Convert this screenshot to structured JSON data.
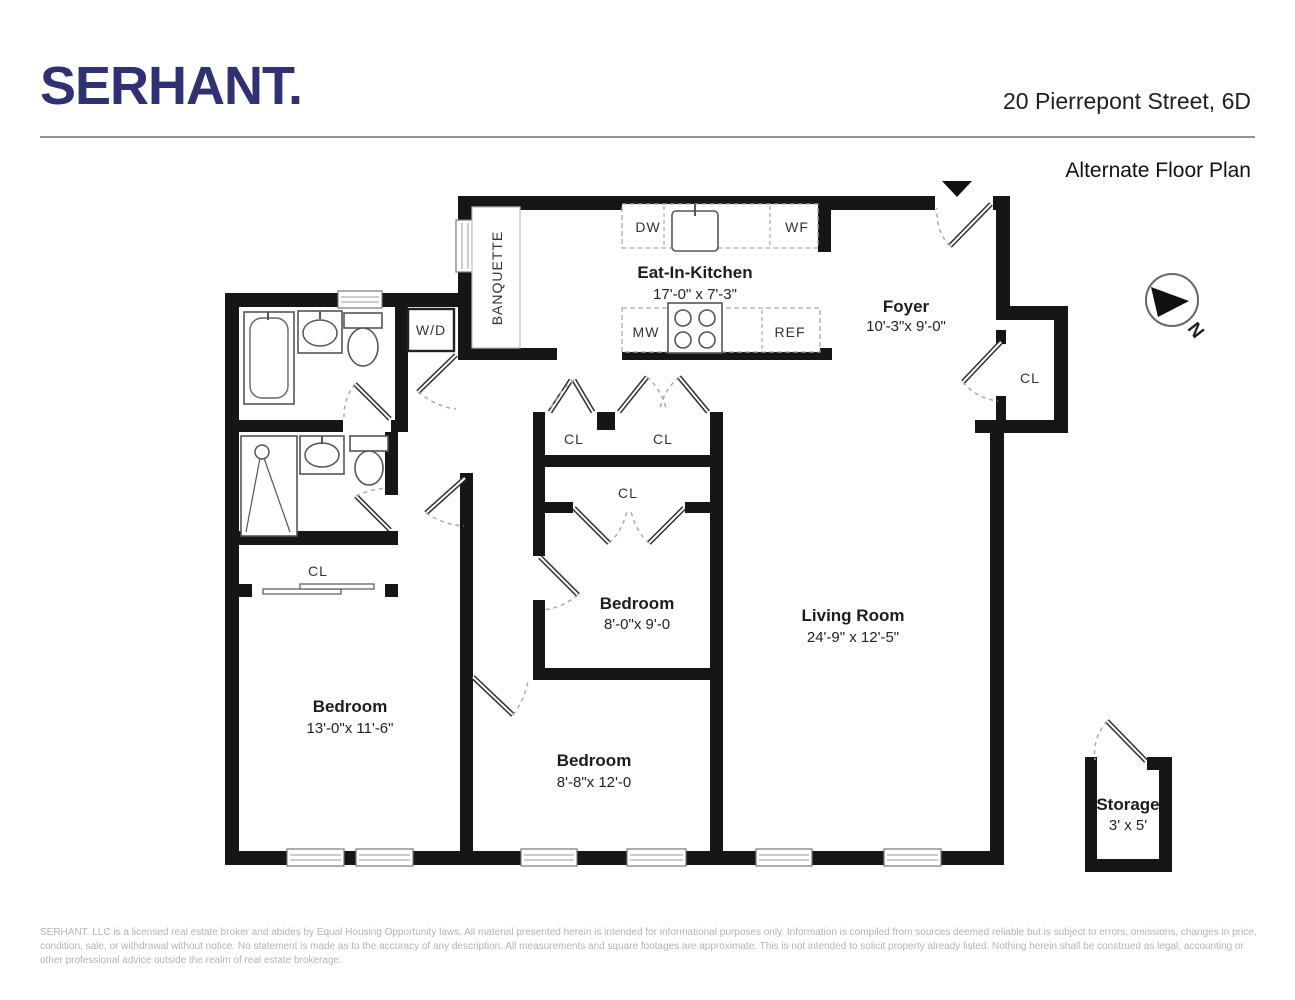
{
  "header": {
    "brand": "SERHANT.",
    "address": "20 Pierrepont Street, 6D",
    "plan_title": "Alternate Floor Plan"
  },
  "compass": {
    "north_label": "N"
  },
  "rooms": {
    "kitchen": {
      "name": "Eat-In-Kitchen",
      "dims": "17'-0\" x 7'-3\""
    },
    "foyer": {
      "name": "Foyer",
      "dims": "10'-3\"x 9'-0\""
    },
    "bedroom_middle": {
      "name": "Bedroom",
      "dims": "8'-0\"x 9'-0"
    },
    "bedroom_left": {
      "name": "Bedroom",
      "dims": "13'-0\"x 11'-6\""
    },
    "bedroom_bottom": {
      "name": "Bedroom",
      "dims": "8'-8\"x 12'-0"
    },
    "living_room": {
      "name": "Living Room",
      "dims": "24'-9\" x 12'-5\""
    },
    "storage": {
      "name": "Storage",
      "dims": "3' x 5'"
    }
  },
  "fixtures": {
    "banquette": "BANQUETTE",
    "washer_dryer": "W/D",
    "dishwasher": "DW",
    "wine_fridge": "WF",
    "microwave": "MW",
    "refrigerator": "REF"
  },
  "closet_label": "CL",
  "footer": {
    "disclaimer": "SERHANT. LLC is a licensed real estate broker and abides by Equal Housing Opportunity laws. All material presented herein is intended for informational purposes only. Information is compiled from sources deemed reliable but is subject to errors, omissions, changes in price, condition, sale, or withdrawal without notice. No statement is made as to the accuracy of any description. All measurements and square footages are approximate. This is not intended to solicit property already listed. Nothing herein shall be construed as legal, accounting or other professional advice outside the realm of real estate brokerage."
  },
  "colors": {
    "brand": "#2e3176",
    "wall": "#161616"
  }
}
